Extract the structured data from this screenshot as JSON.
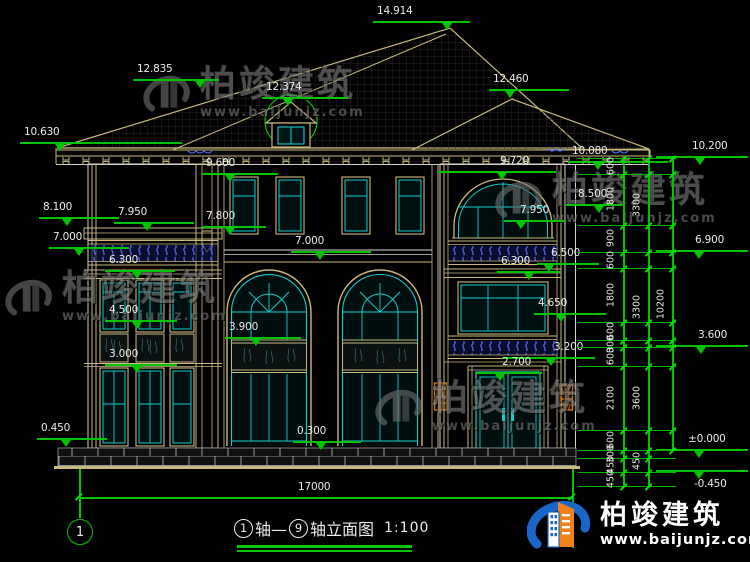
{
  "drawing": {
    "title_axis_from": "1",
    "title_joiner": "轴—",
    "title_axis_to": "9",
    "title_suffix": "轴立面图",
    "scale": "1:100",
    "overall_width_dim": "17000",
    "axis_bubble_left": "1"
  },
  "brand": {
    "name": "柏竣建筑",
    "url": "www.baijunjz.com"
  },
  "levels": [
    {
      "label": "14.914",
      "tx": 377,
      "ty": 6,
      "lx": 373,
      "lw": 97,
      "ly": 21,
      "trix": 447
    },
    {
      "label": "12.835",
      "tx": 137,
      "ty": 64,
      "lx": 133,
      "lw": 86,
      "ly": 79,
      "trix": 200
    },
    {
      "label": "12.374",
      "tx": 266,
      "ty": 82,
      "lx": 262,
      "lw": 86,
      "ly": 97,
      "trix": 288
    },
    {
      "label": "12.460",
      "tx": 493,
      "ty": 74,
      "lx": 489,
      "lw": 80,
      "ly": 89,
      "trix": 510
    },
    {
      "label": "10.630",
      "tx": 24,
      "ty": 127,
      "lx": 20,
      "lw": 162,
      "ly": 142,
      "trix": 60
    },
    {
      "label": "10.080",
      "tx": 572,
      "ty": 146,
      "lx": 568,
      "lw": 100,
      "ly": 161,
      "trix": 598
    },
    {
      "label": "10.200",
      "tx": 692,
      "ty": 141,
      "lx": 656,
      "lw": 92,
      "ly": 156,
      "trix": 700
    },
    {
      "label": "9.600",
      "tx": 206,
      "ty": 158,
      "lx": 202,
      "lw": 76,
      "ly": 173,
      "trix": 230
    },
    {
      "label": "9.720",
      "tx": 500,
      "ty": 156,
      "lx": 438,
      "lw": 118,
      "ly": 171,
      "trix": 502
    },
    {
      "label": "8.500",
      "tx": 578,
      "ty": 189,
      "lx": 566,
      "lw": 56,
      "ly": 204,
      "trix": 599
    },
    {
      "label": "8.100",
      "tx": 43,
      "ty": 202,
      "lx": 39,
      "lw": 80,
      "ly": 217,
      "trix": 67
    },
    {
      "label": "7.950",
      "tx": 118,
      "ty": 207,
      "lx": 114,
      "lw": 80,
      "ly": 222,
      "trix": 147
    },
    {
      "label": "7.800",
      "tx": 206,
      "ty": 211,
      "lx": 202,
      "lw": 64,
      "ly": 226,
      "trix": 230
    },
    {
      "label": "7.950",
      "tx": 520,
      "ty": 205,
      "lx": 504,
      "lw": 62,
      "ly": 220,
      "trix": 521
    },
    {
      "label": "7.000",
      "tx": 53,
      "ty": 232,
      "lx": 49,
      "lw": 80,
      "ly": 247,
      "trix": 79
    },
    {
      "label": "7.000",
      "tx": 295,
      "ty": 236,
      "lx": 291,
      "lw": 80,
      "ly": 251,
      "trix": 320
    },
    {
      "label": "6.900",
      "tx": 695,
      "ty": 235,
      "lx": 656,
      "lw": 92,
      "ly": 250,
      "trix": 699
    },
    {
      "label": "6.300",
      "tx": 109,
      "ty": 255,
      "lx": 105,
      "lw": 70,
      "ly": 270,
      "trix": 137
    },
    {
      "label": "6.500",
      "tx": 551,
      "ty": 248,
      "lx": 537,
      "lw": 62,
      "ly": 263,
      "trix": 549
    },
    {
      "label": "6.300",
      "tx": 501,
      "ty": 256,
      "lx": 497,
      "lw": 64,
      "ly": 271,
      "trix": 529
    },
    {
      "label": "4.650",
      "tx": 538,
      "ty": 298,
      "lx": 534,
      "lw": 72,
      "ly": 313,
      "trix": 561
    },
    {
      "label": "4.500",
      "tx": 109,
      "ty": 305,
      "lx": 105,
      "lw": 72,
      "ly": 320,
      "trix": 137
    },
    {
      "label": "3.900",
      "tx": 229,
      "ty": 322,
      "lx": 225,
      "lw": 76,
      "ly": 337,
      "trix": 256
    },
    {
      "label": "3.600",
      "tx": 698,
      "ty": 330,
      "lx": 656,
      "lw": 92,
      "ly": 345,
      "trix": 701
    },
    {
      "label": "3.200",
      "tx": 554,
      "ty": 342,
      "lx": 503,
      "lw": 92,
      "ly": 357,
      "trix": 551
    },
    {
      "label": "3.000",
      "tx": 109,
      "ty": 349,
      "lx": 105,
      "lw": 72,
      "ly": 364,
      "trix": 137
    },
    {
      "label": "2.700",
      "tx": 502,
      "ty": 357,
      "lx": 476,
      "lw": 66,
      "ly": 372,
      "trix": 500
    },
    {
      "label": "±0.000",
      "tx": 688,
      "ty": 434,
      "lx": 656,
      "lw": 92,
      "ly": 449,
      "trix": 699
    },
    {
      "label": "-0.450",
      "tx": 694,
      "ty": 479,
      "lx": 656,
      "lw": 92,
      "ly": 470,
      "trix": 699
    },
    {
      "label": "0.450",
      "tx": 41,
      "ty": 423,
      "lx": 37,
      "lw": 70,
      "ly": 438,
      "trix": 66
    },
    {
      "label": "0.300",
      "tx": 297,
      "ty": 426,
      "lx": 293,
      "lw": 68,
      "ly": 441,
      "trix": 321
    }
  ],
  "right_dim_chain": {
    "ext_x1": 578,
    "ext_x2": 676,
    "boundaries": [
      158,
      174,
      225,
      252,
      268,
      322,
      340,
      347,
      366,
      430,
      450,
      458,
      472,
      486
    ],
    "lines": [
      {
        "x": 623,
        "y1": 158,
        "y2": 486
      },
      {
        "x": 648,
        "y1": 158,
        "y2": 486
      },
      {
        "x": 672,
        "y1": 158,
        "y2": 450
      }
    ],
    "inner_x": 611,
    "inner": [
      {
        "label": "600",
        "y": 166
      },
      {
        "label": "1800",
        "y": 199
      },
      {
        "label": "900",
        "y": 238
      },
      {
        "label": "600",
        "y": 260
      },
      {
        "label": "1800",
        "y": 295
      },
      {
        "label": "600",
        "y": 331
      },
      {
        "label": "300",
        "y": 344
      },
      {
        "label": "600",
        "y": 356
      },
      {
        "label": "2100",
        "y": 398
      },
      {
        "label": "600",
        "y": 440
      },
      {
        "label": "300",
        "y": 454
      },
      {
        "label": "450",
        "y": 465
      },
      {
        "label": "450",
        "y": 479
      }
    ],
    "mid_x": 637,
    "mid": [
      {
        "label": "3300",
        "y": 205
      },
      {
        "label": "3300",
        "y": 307
      },
      {
        "label": "3600",
        "y": 398
      },
      {
        "label": "450",
        "y": 461
      }
    ],
    "outer_x": 661,
    "outer": {
      "label": "10200",
      "y": 304
    }
  },
  "bottom_dim": {
    "x1": 79,
    "x2": 572,
    "y": 497,
    "text_x": 298,
    "text_y": 482
  },
  "watermarks": [
    {
      "x": 140,
      "y": 66
    },
    {
      "x": 492,
      "y": 172
    },
    {
      "x": 2,
      "y": 270
    },
    {
      "x": 372,
      "y": 380
    }
  ],
  "colors": {
    "dim_green": "#00c400",
    "frame_tan": "#C9B97E",
    "glass_cyan": "#10cfcf",
    "wall_white": "#d4d4d4",
    "baluster_blue": "#5a6aff",
    "downspout_orange": "#E07818",
    "logo_blue": "#1766C8",
    "logo_orange": "#F28118"
  }
}
